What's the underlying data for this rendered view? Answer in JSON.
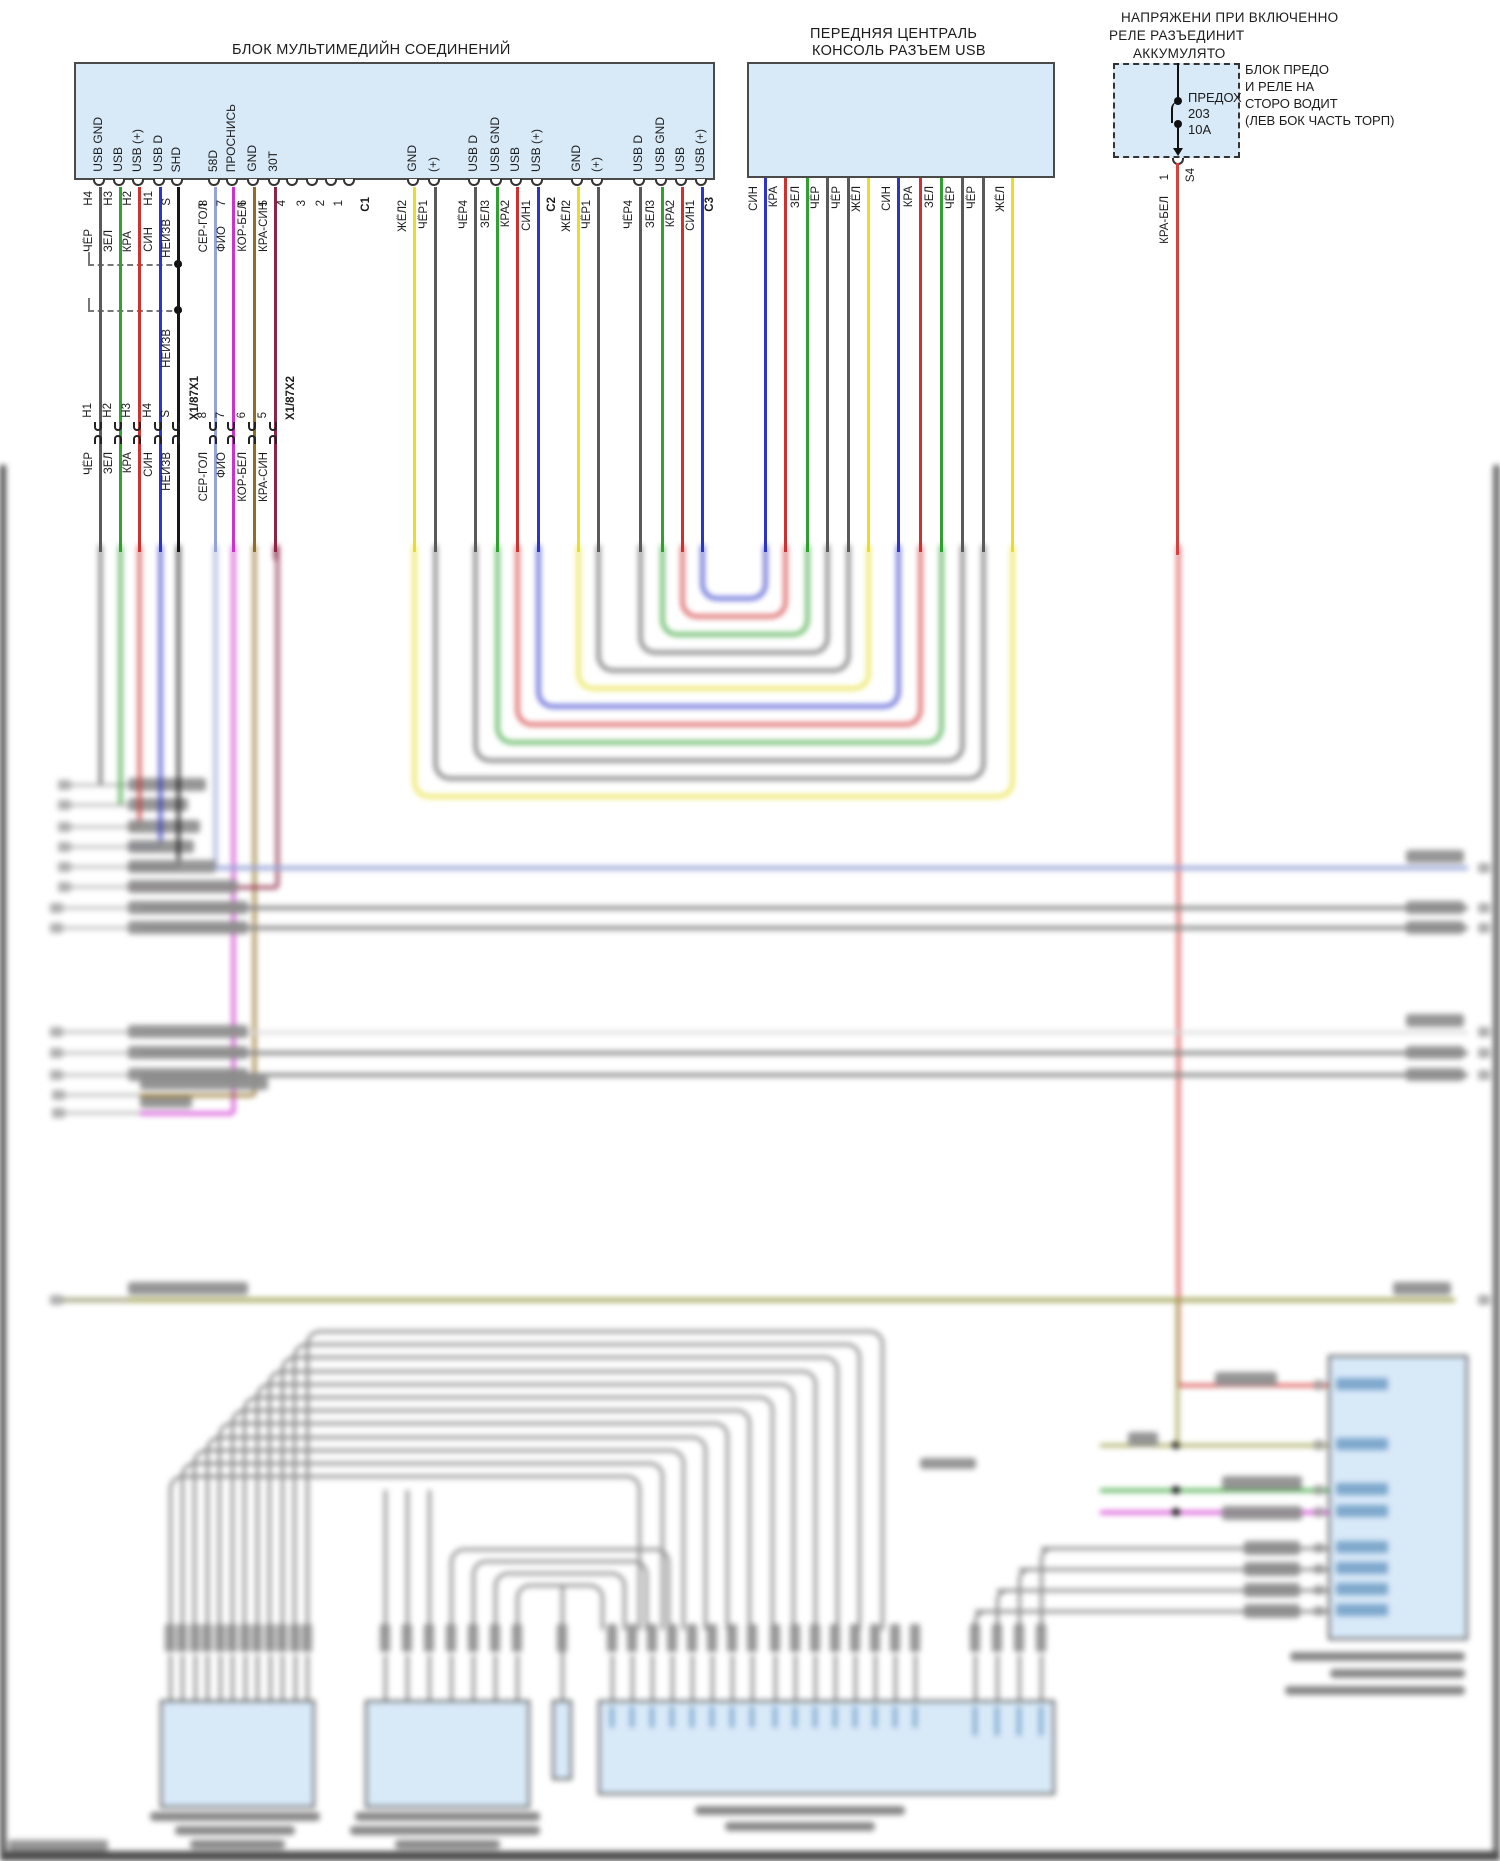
{
  "titles": {
    "mm_block": "БЛОК МУЛЬТИМЕДИЙН СОЕДИНЕНИЙ",
    "console_l1": "ПЕРЕДНЯЯ ЦЕНТРАЛЬ",
    "console_l2": "КОНСОЛЬ РАЗЪЕМ USB",
    "relay_l1": "НАПРЯЖЕНИ ПРИ ВКЛЮЧЕННО",
    "relay_l2": "РЕЛЕ РАЗЪЕДИНИТ",
    "relay_l3": "АККУМУЛЯТО",
    "fusebox_l1": "БЛОК ПРЕДО",
    "fusebox_l2": "И РЕЛЕ НА",
    "fusebox_l3": "СТОРО ВОДИТ",
    "fusebox_l4": "(ЛЕВ БОК ЧАСТЬ ТОРП)"
  },
  "fuse": {
    "name": "ПРЕДОХ",
    "number": "203",
    "rating": "10A",
    "pin": "1",
    "connector": "S4",
    "wire_label": "КРА-БЕЛ"
  },
  "palette": {
    "CHER": "#5a5a5a",
    "ZEL": "#2fa12f",
    "KRA": "#d03030",
    "SIN": "#2b35c8",
    "NEIZV": "#161616",
    "SERGOL": "#96a3d6",
    "FIO": "#cf30cf",
    "KORBEL": "#8f6f22",
    "KRASIN": "#8c2545",
    "ZHEL": "#e6df2a",
    "KRABEL": "#d84040",
    "OLIVE": "#a0a050",
    "BUNDLE": "#878787",
    "FAINT": "#d9d9d9",
    "BLOCKBLUE": "#d8e9f8"
  },
  "mm": {
    "bottom_pins": [
      {
        "x": 100,
        "id": "H4",
        "signal": "USB GND",
        "wire": "CHER",
        "wlabel": "ЧЁР"
      },
      {
        "x": 120,
        "id": "H3",
        "signal": "USB",
        "wire": "ZEL",
        "wlabel": "ЗЕЛ"
      },
      {
        "x": 139,
        "id": "H2",
        "signal": "USB (+)",
        "wire": "KRA",
        "wlabel": "КРА"
      },
      {
        "x": 160,
        "id": "H1",
        "signal": "USB D",
        "wire": "SIN",
        "wlabel": "СИН"
      },
      {
        "x": 178,
        "id": "S",
        "signal": "SHD",
        "wire": "NEIZV",
        "wlabel": "НЕИЗВ"
      },
      {
        "x": 215,
        "id": "8",
        "signal": "58D",
        "wire": "SERGOL",
        "wlabel": "СЕР-ГОЛ"
      },
      {
        "x": 233,
        "id": "7",
        "signal": "ПРОСНИСЬ",
        "wire": "FIO",
        "wlabel": "ФИО"
      },
      {
        "x": 254,
        "id": "6",
        "signal": "GND",
        "wire": "KORBEL",
        "wlabel": "КОР-БЕЛ"
      },
      {
        "x": 275,
        "id": "5",
        "signal": "30T",
        "wire": "KRASIN",
        "wlabel": "КРА-СИН"
      },
      {
        "x": 293,
        "id": "4"
      },
      {
        "x": 313,
        "id": "3"
      },
      {
        "x": 332,
        "id": "2"
      },
      {
        "x": 350,
        "id": "1"
      },
      {
        "x": 368,
        "id": "C1",
        "conn": true
      },
      {
        "x": 414,
        "id": "2",
        "signal": "GND",
        "wire": "ZHEL",
        "wlabel": "ЖЁЛ"
      },
      {
        "x": 435,
        "id": "1",
        "signal": "(+)",
        "wire": "CHER",
        "wlabel": "ЧЁР"
      },
      {
        "x": 475,
        "id": "4",
        "signal": "USB D",
        "wire": "CHER",
        "wlabel": "ЧЁР"
      },
      {
        "x": 497,
        "id": "3",
        "signal": "USB GND",
        "wire": "ZEL",
        "wlabel": "ЗЕЛ"
      },
      {
        "x": 517,
        "id": "2",
        "signal": "USB",
        "wire": "KRA",
        "wlabel": "КРА"
      },
      {
        "x": 538,
        "id": "1",
        "signal": "USB (+)",
        "wire": "SIN",
        "wlabel": "СИН"
      },
      {
        "x": 554,
        "id": "C2",
        "conn": true
      },
      {
        "x": 578,
        "id": "2",
        "signal": "GND",
        "wire": "ZHEL",
        "wlabel": "ЖЁЛ"
      },
      {
        "x": 598,
        "id": "1",
        "signal": "(+)",
        "wire": "CHER",
        "wlabel": "ЧЁР"
      },
      {
        "x": 640,
        "id": "4",
        "signal": "USB D",
        "wire": "CHER",
        "wlabel": "ЧЁР"
      },
      {
        "x": 662,
        "id": "3",
        "signal": "USB GND",
        "wire": "ZEL",
        "wlabel": "ЗЕЛ"
      },
      {
        "x": 682,
        "id": "2",
        "signal": "USB",
        "wire": "KRA",
        "wlabel": "КРА"
      },
      {
        "x": 702,
        "id": "1",
        "signal": "USB (+)",
        "wire": "SIN",
        "wlabel": "СИН"
      },
      {
        "x": 712,
        "id": "C3",
        "conn": true
      }
    ],
    "shield_note": "НЕИЗВ"
  },
  "connector_row": [
    {
      "x": 100,
      "id": "H1",
      "wlabel": "ЧЁР"
    },
    {
      "x": 120,
      "id": "H2",
      "wlabel": "ЗЕЛ"
    },
    {
      "x": 139,
      "id": "H3",
      "wlabel": "КРА"
    },
    {
      "x": 160,
      "id": "H4",
      "wlabel": "СИН"
    },
    {
      "x": 178,
      "id": "S",
      "wlabel": "НЕИЗВ"
    },
    {
      "x": 197,
      "id": "X1/87X1",
      "conn": true
    },
    {
      "x": 215,
      "id": "8",
      "wlabel": "СЕР-ГОЛ"
    },
    {
      "x": 233,
      "id": "7",
      "wlabel": "ФИО"
    },
    {
      "x": 254,
      "id": "6",
      "wlabel": "КОР-БЕЛ"
    },
    {
      "x": 275,
      "id": "5",
      "wlabel": "КРА-СИН"
    },
    {
      "x": 293,
      "id": "X1/87X2",
      "conn": true
    }
  ],
  "console_wires": [
    {
      "x": 765,
      "wire": "SIN",
      "wlabel": "СИН"
    },
    {
      "x": 785,
      "wire": "KRA",
      "wlabel": "КРА"
    },
    {
      "x": 807,
      "wire": "ZEL",
      "wlabel": "ЗЕЛ"
    },
    {
      "x": 827,
      "wire": "CHER",
      "wlabel": "ЧЁР"
    },
    {
      "x": 848,
      "wire": "CHER",
      "wlabel": "ЧЁР"
    },
    {
      "x": 868,
      "wire": "ZHEL",
      "wlabel": "ЖЁЛ"
    },
    {
      "x": 898,
      "wire": "SIN",
      "wlabel": "СИН"
    },
    {
      "x": 920,
      "wire": "KRA",
      "wlabel": "КРА"
    },
    {
      "x": 941,
      "wire": "ZEL",
      "wlabel": "ЗЕЛ"
    },
    {
      "x": 962,
      "wire": "CHER",
      "wlabel": "ЧЁР"
    },
    {
      "x": 983,
      "wire": "CHER",
      "wlabel": "ЧЁР"
    },
    {
      "x": 1012,
      "wire": "ZHEL",
      "wlabel": "ЖЁЛ"
    }
  ],
  "schematic": {
    "u_links": [
      {
        "l": 702,
        "r": 765,
        "b": 600,
        "wire": "SIN"
      },
      {
        "l": 682,
        "r": 785,
        "b": 618,
        "wire": "KRA"
      },
      {
        "l": 662,
        "r": 807,
        "b": 636,
        "wire": "ZEL"
      },
      {
        "l": 640,
        "r": 827,
        "b": 654,
        "wire": "CHER"
      },
      {
        "l": 598,
        "r": 848,
        "b": 672,
        "wire": "CHER"
      },
      {
        "l": 578,
        "r": 868,
        "b": 690,
        "wire": "ZHEL"
      },
      {
        "l": 538,
        "r": 898,
        "b": 708,
        "wire": "SIN"
      },
      {
        "l": 517,
        "r": 920,
        "b": 726,
        "wire": "KRA"
      },
      {
        "l": 497,
        "r": 941,
        "b": 744,
        "wire": "ZEL"
      },
      {
        "l": 475,
        "r": 962,
        "b": 762,
        "wire": "CHER"
      },
      {
        "l": 435,
        "r": 983,
        "b": 780,
        "wire": "CHER"
      },
      {
        "l": 414,
        "r": 1012,
        "b": 798,
        "wire": "ZHEL"
      }
    ],
    "left_rows": [
      {
        "y": 785,
        "vx": 100,
        "wire": "CHER",
        "bw": 78
      },
      {
        "y": 805,
        "vx": 120,
        "wire": "ZEL",
        "bw": 60
      },
      {
        "y": 827,
        "vx": 139,
        "wire": "KRA",
        "bw": 72
      },
      {
        "y": 847,
        "vx": 160,
        "wire": "SIN",
        "bw": 66
      },
      {
        "y": 867,
        "vx": 178,
        "wire": "NEIZV",
        "bw": 88
      },
      {
        "y": 887,
        "vx": 277,
        "wire": "KRASIN",
        "bw": 110
      }
    ],
    "long_rows": [
      {
        "y": 868,
        "x1": 215,
        "x2": 1468,
        "wire": "SERGOL",
        "lb": false,
        "rb": true
      },
      {
        "y": 908,
        "x1": 140,
        "x2": 1468,
        "wire": "BUNDLE",
        "lb": true,
        "rb": true
      },
      {
        "y": 928,
        "x1": 140,
        "x2": 1468,
        "wire": "BUNDLE",
        "lb": true,
        "rb": true
      },
      {
        "y": 1032,
        "x1": 140,
        "x2": 1468,
        "wire": "FAINT",
        "lb": true,
        "rb": true
      },
      {
        "y": 1053,
        "x1": 140,
        "x2": 1468,
        "wire": "BUNDLE",
        "lb": true,
        "rb": true
      },
      {
        "y": 1075,
        "x1": 140,
        "x2": 1468,
        "wire": "BUNDLE",
        "lb": true,
        "rb": true
      },
      {
        "y": 1300,
        "x1": 62,
        "x2": 1455,
        "wire": "OLIVE",
        "lb": true,
        "rb": true
      }
    ],
    "mid_drops": [
      {
        "vx": 233,
        "y": 1113,
        "wire": "FIO",
        "bw": 52
      },
      {
        "vx": 254,
        "y": 1095,
        "wire": "KORBEL",
        "bw": 128
      }
    ],
    "bundle": {
      "count": 12,
      "left0": 307,
      "ldx": -12.45,
      "top0": 1330,
      "tdy": 13.2,
      "right0": 882,
      "rdx": -22,
      "legbot": 1630
    },
    "mid_corners": [
      {
        "lx": 451,
        "ty": 1548,
        "rx": 668
      },
      {
        "lx": 473,
        "ty": 1560,
        "rx": 646
      },
      {
        "lx": 495,
        "ty": 1572,
        "rx": 624
      },
      {
        "lx": 517,
        "ty": 1584,
        "rx": 602
      }
    ],
    "right_corners": [
      {
        "vx": 1041,
        "y": 1548
      },
      {
        "vx": 1019,
        "y": 1569
      },
      {
        "vx": 997,
        "y": 1590
      },
      {
        "vx": 975,
        "y": 1611
      }
    ],
    "blocks_bottom": [
      {
        "x": 160,
        "y": 1700,
        "w": 155,
        "h": 108,
        "pins": [
          170,
          182,
          195,
          207,
          220,
          232,
          245,
          257,
          270,
          282,
          295,
          307
        ],
        "caps": [
          [
            150,
            1812,
            170
          ],
          [
            175,
            1826,
            120
          ],
          [
            190,
            1840,
            95
          ]
        ]
      },
      {
        "x": 365,
        "y": 1700,
        "w": 165,
        "h": 108,
        "pins": [
          385,
          407,
          429,
          451,
          473,
          495,
          517
        ],
        "caps": [
          [
            355,
            1812,
            185
          ],
          [
            350,
            1826,
            190
          ],
          [
            395,
            1840,
            105
          ]
        ]
      },
      {
        "x": 552,
        "y": 1700,
        "w": 20,
        "h": 80,
        "pins": [
          562
        ],
        "caps": []
      },
      {
        "x": 598,
        "y": 1700,
        "w": 457,
        "h": 95,
        "pins": [
          612,
          632,
          652,
          672,
          692,
          712,
          732,
          752,
          775,
          795,
          815,
          835,
          855,
          875,
          895,
          915,
          975,
          997,
          1019,
          1041
        ],
        "caps": [
          [
            695,
            1806,
            210
          ],
          [
            725,
            1822,
            150
          ]
        ]
      }
    ],
    "right_block": {
      "x": 1328,
      "y": 1355,
      "w": 140,
      "h": 285,
      "entries": [
        {
          "y": 1385,
          "wire": "KRABEL",
          "x1": 1178,
          "label": [
            1215,
            1372,
            62
          ]
        },
        {
          "y": 1445,
          "wire": "OLIVE",
          "x1": 1100,
          "dot": 1176,
          "label": [
            1128,
            1432,
            30
          ]
        },
        {
          "y": 1490,
          "wire": "ZEL",
          "x1": 1100,
          "dot": 1176,
          "label": [
            1222,
            1476,
            80
          ]
        },
        {
          "y": 1512,
          "wire": "FIO",
          "x1": 1100,
          "dot": 1176,
          "label": [
            1222,
            1506,
            80
          ]
        },
        {
          "y": 1548,
          "wire": "BUNDLE",
          "x1": 1041,
          "label": [
            1244,
            1541,
            56
          ]
        },
        {
          "y": 1569,
          "wire": "BUNDLE",
          "x1": 1019,
          "label": [
            1244,
            1562,
            56
          ]
        },
        {
          "y": 1590,
          "wire": "BUNDLE",
          "x1": 997,
          "label": [
            1244,
            1583,
            56
          ]
        },
        {
          "y": 1611,
          "wire": "BUNDLE",
          "x1": 975,
          "label": [
            1244,
            1604,
            56
          ]
        }
      ],
      "pinbar_ys": [
        1378,
        1438,
        1483,
        1505,
        1541,
        1562,
        1583,
        1604
      ],
      "caps": [
        [
          1290,
          1652,
          175
        ],
        [
          1330,
          1669,
          135
        ],
        [
          1285,
          1686,
          180
        ]
      ]
    },
    "misc_labels": [
      [
        920,
        1458,
        56
      ],
      [
        8,
        1840,
        100
      ]
    ]
  }
}
